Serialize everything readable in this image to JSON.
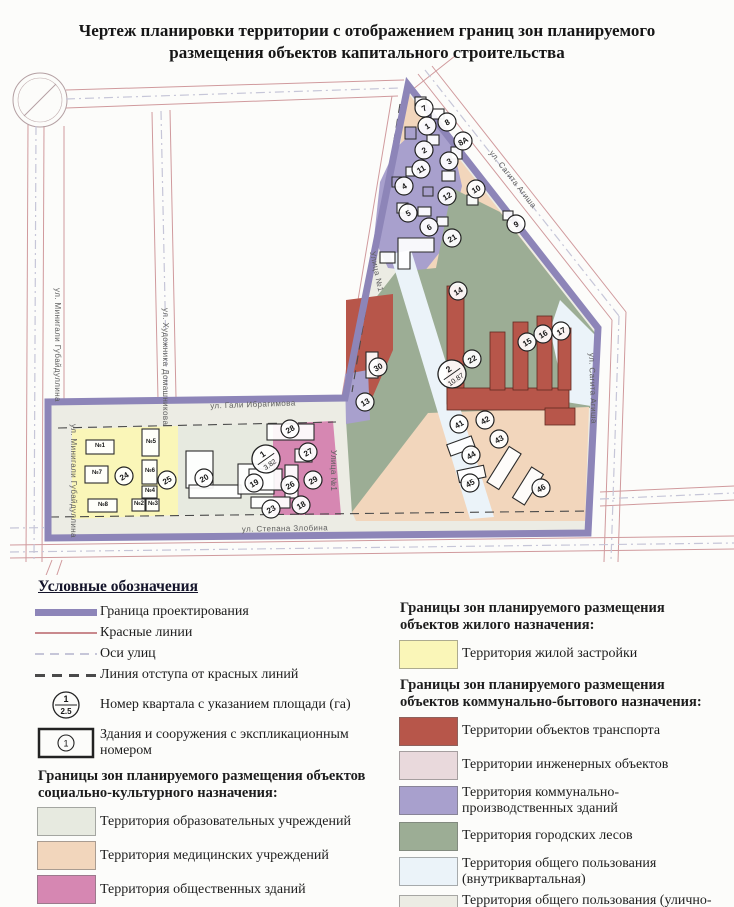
{
  "title": {
    "line1": "Чертеж планировки территории с отображением границ зон планируемого",
    "line2": "размещения объектов капитального строительства"
  },
  "colors": {
    "boundary": "#8d85b8",
    "red_line": "#c9898d",
    "axis_line": "#c6c6d8",
    "setback_line": "#4a4a4a",
    "marker_stroke": "#222222",
    "zones": {
      "residential": "#faf6b8",
      "education": "#e7eae0",
      "medical": "#f2d6bc",
      "public": "#d687b2",
      "transport": "#b7564a",
      "engineering": "#e9d9dc",
      "communal": "#a8a0cd",
      "forest": "#9cad95",
      "common_inner": "#ebf3f9",
      "street_network": "#ecece4"
    }
  },
  "map": {
    "streets": [
      {
        "label": "ул. Минигали Губайдуллина",
        "x": 55,
        "y": 288,
        "rotate": 90,
        "anchor": "start"
      },
      {
        "label": "ул. Минигали Губайдуллина",
        "x": 71,
        "y": 424,
        "rotate": 90,
        "anchor": "start"
      },
      {
        "label": "ул. Художника Домашникова",
        "x": 163,
        "y": 308,
        "rotate": 90,
        "anchor": "start"
      },
      {
        "label": "ул. Гали Ибрагимова",
        "x": 253,
        "y": 407,
        "rotate": -2,
        "anchor": "middle"
      },
      {
        "label": "ул. Степана Злобина",
        "x": 285,
        "y": 531,
        "rotate": -1,
        "anchor": "middle"
      },
      {
        "label": "Улица №1",
        "x": 370,
        "y": 252,
        "rotate": 78,
        "anchor": "start"
      },
      {
        "label": "Улица №1",
        "x": 331,
        "y": 450,
        "rotate": 90,
        "anchor": "start"
      },
      {
        "label": "ул. Сагита Агиша",
        "x": 489,
        "y": 153,
        "rotate": 52,
        "anchor": "start"
      },
      {
        "label": "ул. Сагита Агиша",
        "x": 589,
        "y": 353,
        "rotate": 88,
        "anchor": "start"
      }
    ],
    "quarters": [
      {
        "number": "1",
        "area": "3.82",
        "x": 266,
        "y": 459
      },
      {
        "number": "2",
        "area": "10.87",
        "x": 452,
        "y": 374
      }
    ],
    "buildings": [
      [
        "7",
        424,
        108
      ],
      [
        "1",
        427,
        126
      ],
      [
        "8",
        447,
        122
      ],
      [
        "8А",
        463,
        141
      ],
      [
        "2",
        424,
        150
      ],
      [
        "3",
        449,
        161
      ],
      [
        "11",
        421,
        169
      ],
      [
        "4",
        404,
        186
      ],
      [
        "10",
        476,
        189
      ],
      [
        "12",
        447,
        196
      ],
      [
        "5",
        408,
        213
      ],
      [
        "6",
        429,
        227
      ],
      [
        "9",
        516,
        224
      ],
      [
        "21",
        452,
        238
      ],
      [
        "13",
        365,
        402
      ],
      [
        "30",
        378,
        367
      ],
      [
        "14",
        458,
        291
      ],
      [
        "15",
        527,
        342
      ],
      [
        "16",
        543,
        334
      ],
      [
        "17",
        561,
        331
      ],
      [
        "22",
        472,
        359
      ],
      [
        "41",
        459,
        424
      ],
      [
        "42",
        485,
        420
      ],
      [
        "43",
        499,
        439
      ],
      [
        "44",
        471,
        455
      ],
      [
        "45",
        470,
        483
      ],
      [
        "46",
        541,
        488
      ],
      [
        "24",
        124,
        476
      ],
      [
        "25",
        167,
        480
      ],
      [
        "20",
        204,
        478
      ],
      [
        "19",
        254,
        483
      ],
      [
        "28",
        290,
        429
      ],
      [
        "27",
        308,
        452
      ],
      [
        "29",
        313,
        480
      ],
      [
        "26",
        290,
        485
      ],
      [
        "23",
        271,
        509
      ],
      [
        "18",
        301,
        505
      ]
    ],
    "houses": [
      [
        "№1",
        100,
        447
      ],
      [
        "№7",
        97,
        474
      ],
      [
        "№8",
        103,
        506
      ],
      [
        "№5",
        151,
        443
      ],
      [
        "№6",
        150,
        472
      ],
      [
        "№4",
        150,
        492
      ],
      [
        "№2",
        139,
        505
      ],
      [
        "№3",
        153,
        505
      ]
    ]
  },
  "legend": {
    "header": "Условные обозначения",
    "line_items": [
      {
        "symbol": "boundary",
        "label": "Граница проектирования"
      },
      {
        "symbol": "red-line",
        "label": "Красные линии"
      },
      {
        "symbol": "axis-line",
        "label": "Оси улиц"
      },
      {
        "symbol": "setback-line",
        "label": "Линия отступа от красных линий"
      },
      {
        "symbol": "quarter",
        "label": "Номер квартала с указанием площади (га)",
        "quarter_number": "1",
        "quarter_area": "2.5"
      },
      {
        "symbol": "building",
        "label": "Здания и сооружения с экспликационным номером",
        "building_number": "1"
      }
    ],
    "groups": [
      {
        "header": "Границы зон планируемого размещения объектов социально-культурного назначения:",
        "column": "left",
        "items": [
          {
            "zone": "education",
            "label": "Территория образовательных учреждений"
          },
          {
            "zone": "medical",
            "label": "Территория медицинских учреждений"
          },
          {
            "zone": "public",
            "label": "Территория общественных зданий"
          }
        ]
      },
      {
        "header": "Границы зон планируемого размещения объектов жилого назначения:",
        "column": "right",
        "items": [
          {
            "zone": "residential",
            "label": "Территория  жилой застройки"
          }
        ]
      },
      {
        "header": "Границы зон планируемого размещения объектов коммунально-бытового назначения:",
        "column": "right",
        "items": [
          {
            "zone": "transport",
            "label": "Территории объектов транспорта"
          },
          {
            "zone": "engineering",
            "label": "Территории инженерных объектов"
          },
          {
            "zone": "communal",
            "label": "Территория коммунально-производственных зданий"
          },
          {
            "zone": "forest",
            "label": "Территория городских лесов"
          },
          {
            "zone": "common_inner",
            "label": "Территория общего пользования (внутриквартальная)"
          },
          {
            "zone": "street_network",
            "label": "Территория общего пользования (улично-дорожная сеть)"
          }
        ]
      }
    ]
  }
}
